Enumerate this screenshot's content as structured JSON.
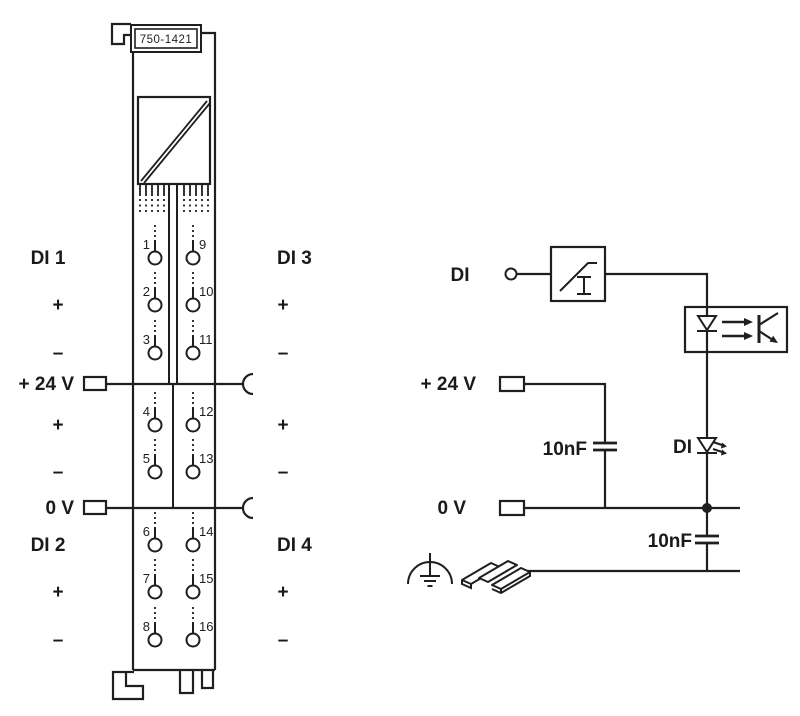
{
  "module": {
    "part_number": "750-1421",
    "left_labels": [
      "DI 1",
      "+",
      "–",
      "+ 24 V",
      "+",
      "–",
      "0 V",
      "DI 2",
      "+",
      "–"
    ],
    "right_labels": [
      "DI 3",
      "+",
      "–",
      "+",
      "–",
      "DI 4",
      "+",
      "–"
    ],
    "contact_numbers_left": [
      "1",
      "2",
      "3",
      "4",
      "5",
      "6",
      "7",
      "8"
    ],
    "contact_numbers_right": [
      "9",
      "10",
      "11",
      "12",
      "13",
      "14",
      "15",
      "16"
    ]
  },
  "circuit": {
    "input_label": "DI",
    "led_label": "DI",
    "supply_label": "+ 24 V",
    "zero_volt_label": "0 V",
    "capacitor_top": "10nF",
    "capacitor_bottom": "10nF"
  },
  "colors": {
    "line": "#1f1f1f",
    "text": "#1a1a1a",
    "background": "#ffffff"
  }
}
